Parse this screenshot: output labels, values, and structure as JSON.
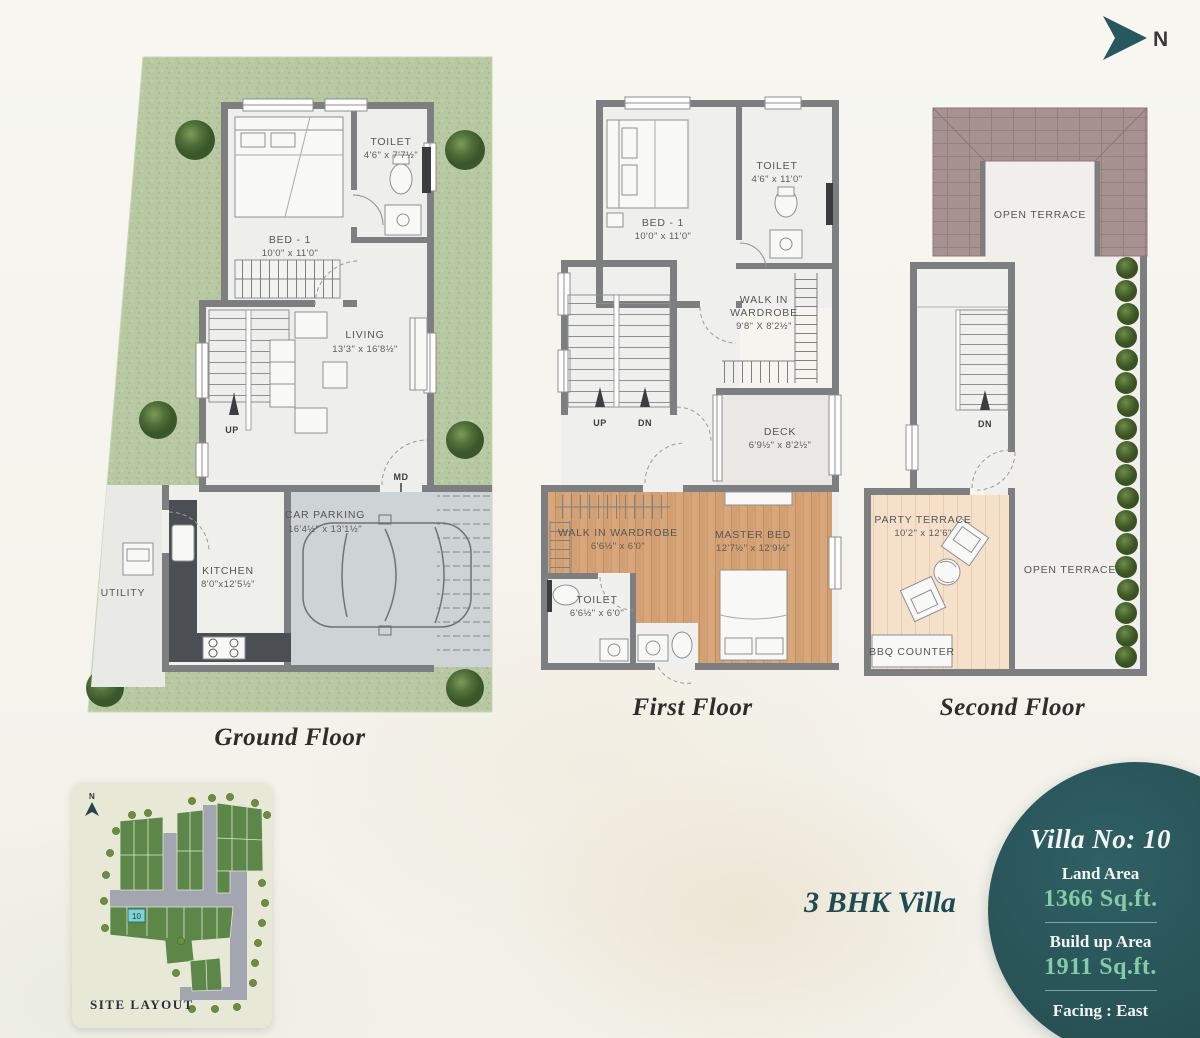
{
  "page": {
    "north_label": "N"
  },
  "ground_floor": {
    "title": "Ground Floor",
    "bed1_name": "BED - 1",
    "bed1_dim": "10'0\" x 11'0\"",
    "toilet_name": "TOILET",
    "toilet_dim": "4'6\" x 7'7½\"",
    "living_name": "LIVING",
    "living_dim": "13'3\" x 16'8½\"",
    "kitchen_name": "KITCHEN",
    "kitchen_dim": "8'0\"x12'5½\"",
    "utility_name": "UTILITY",
    "parking_name": "CAR PARKING",
    "parking_dim": "16'4½\" x 13'1½\"",
    "up": "UP",
    "md": "MD"
  },
  "first_floor": {
    "title": "First Floor",
    "bed1_name": "BED - 1",
    "bed1_dim": "10'0\" x 11'0\"",
    "toilet_name": "TOILET",
    "toilet_dim": "4'6\" x 11'0\"",
    "wiw_top_l1": "WALK IN",
    "wiw_top_l2": "WARDROBE",
    "wiw_top_dim": "9'8\" X 8'2½\"",
    "deck_name": "DECK",
    "deck_dim": "6'9½\" x 8'2½\"",
    "wiw_name": "WALK IN WARDROBE",
    "wiw_dim": "6'6½\" x 6'0\"",
    "master_name": "MASTER BED",
    "master_dim": "12'7½\" x 12'9½\"",
    "toilet2_name": "TOILET",
    "toilet2_dim": "6'6½\" x 6'0\"",
    "up": "UP",
    "dn": "DN"
  },
  "second_floor": {
    "title": "Second Floor",
    "terrace_top": "OPEN TERRACE",
    "terrace_right": "OPEN TERRACE",
    "party_name": "PARTY TERRACE",
    "party_dim": "10'2\" x 12'6\"",
    "bbq": "BBQ COUNTER",
    "dn": "DN"
  },
  "site_layout": {
    "title": "SITE LAYOUT",
    "plot_no": "10",
    "north_label": "N"
  },
  "villa_info": {
    "bhk_title": "3 BHK Villa",
    "villa_no": "Villa No: 10",
    "land_label": "Land Area",
    "land_value": "1366 Sq.ft.",
    "build_label": "Build up Area",
    "build_value": "1911 Sq.ft.",
    "facing": "Facing : East"
  },
  "colors": {
    "accent_teal": "#2b575b",
    "value_green": "#85cba6",
    "grass": "#b7c8a2",
    "wood": "#d7a67a",
    "tile": "#a8928f",
    "wall": "#7c7e80",
    "plot_cyan": "#7fd3d6"
  }
}
